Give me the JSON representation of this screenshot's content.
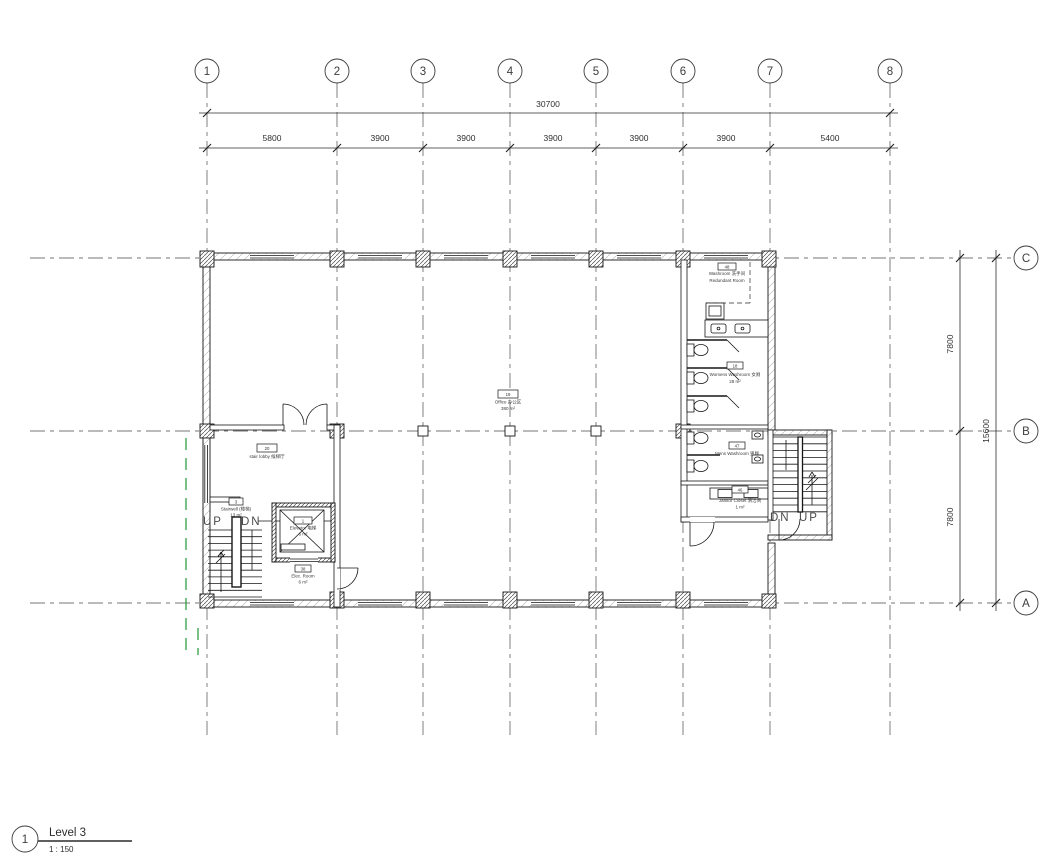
{
  "sheet": {
    "view_title": {
      "detail_number": "1",
      "name": "Level 3",
      "scale": "1 : 150"
    },
    "grid": {
      "columns": [
        "1",
        "2",
        "3",
        "4",
        "5",
        "6",
        "7",
        "8"
      ],
      "rows": [
        "C",
        "B",
        "A"
      ]
    },
    "dimensions": {
      "top_overall": "30700",
      "top_bays": [
        "5800",
        "3900",
        "3900",
        "3900",
        "3900",
        "3900",
        "5400"
      ],
      "right_bays": [
        "7800",
        "7800"
      ],
      "right_overall": "15600"
    },
    "rooms": {
      "washroom_redundant": {
        "tag": "48",
        "line1": "Washroom 洗手间",
        "line2": "Redundant Room"
      },
      "womens_washroom": {
        "tag": "18",
        "name": "Womens Washroom 女厕",
        "area": "28 m²"
      },
      "mens_washroom": {
        "tag": "47",
        "name": "Mens Washroom 男厕"
      },
      "janitor_closet": {
        "tag": "46",
        "name": "Janitor Closet 清洁间",
        "area": "1 m²"
      },
      "office": {
        "tag": "19",
        "name": "Office 办公区",
        "area": "380 m²"
      },
      "stair_lobby": {
        "tag": "20",
        "name": "stair lobby 候梯厅"
      },
      "stairwell": {
        "tag": "3",
        "name": "Stairwell (楼梯)",
        "area": "13 m²"
      },
      "elevator": {
        "tag": "1",
        "name": "Elevator 电梯",
        "area": "6 m²"
      },
      "elec_room": {
        "tag": "38",
        "name": "Elec. Room",
        "area": "6 m²"
      }
    },
    "stair_annotations": {
      "left_up": "UP",
      "left_dn": "DN",
      "right_dn": "DN",
      "right_up": "UP"
    }
  },
  "colors": {
    "background": "#ffffff",
    "line": "#161616",
    "text": "#3a3a3a",
    "green_dashed": "#2f9e44"
  }
}
